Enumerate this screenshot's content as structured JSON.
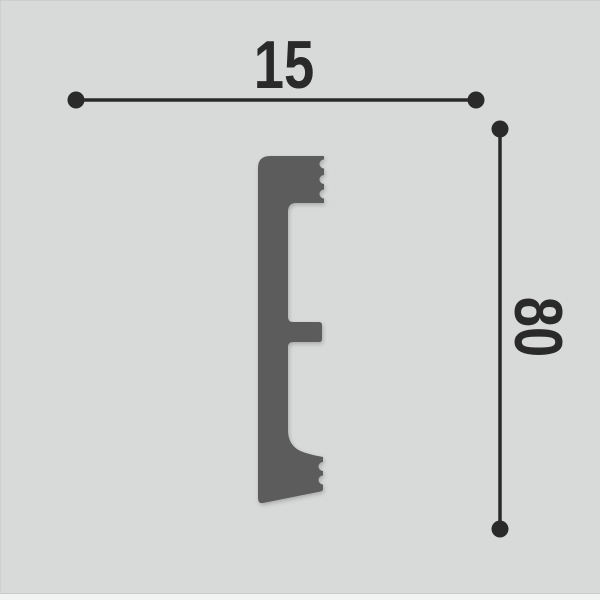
{
  "colors": {
    "background": "#d8dad9",
    "profile": "#5b5b5b",
    "dimension": "#2a2a2a"
  },
  "diagram": {
    "width_dimension": {
      "label": "15"
    },
    "height_dimension": {
      "label": "80"
    }
  }
}
